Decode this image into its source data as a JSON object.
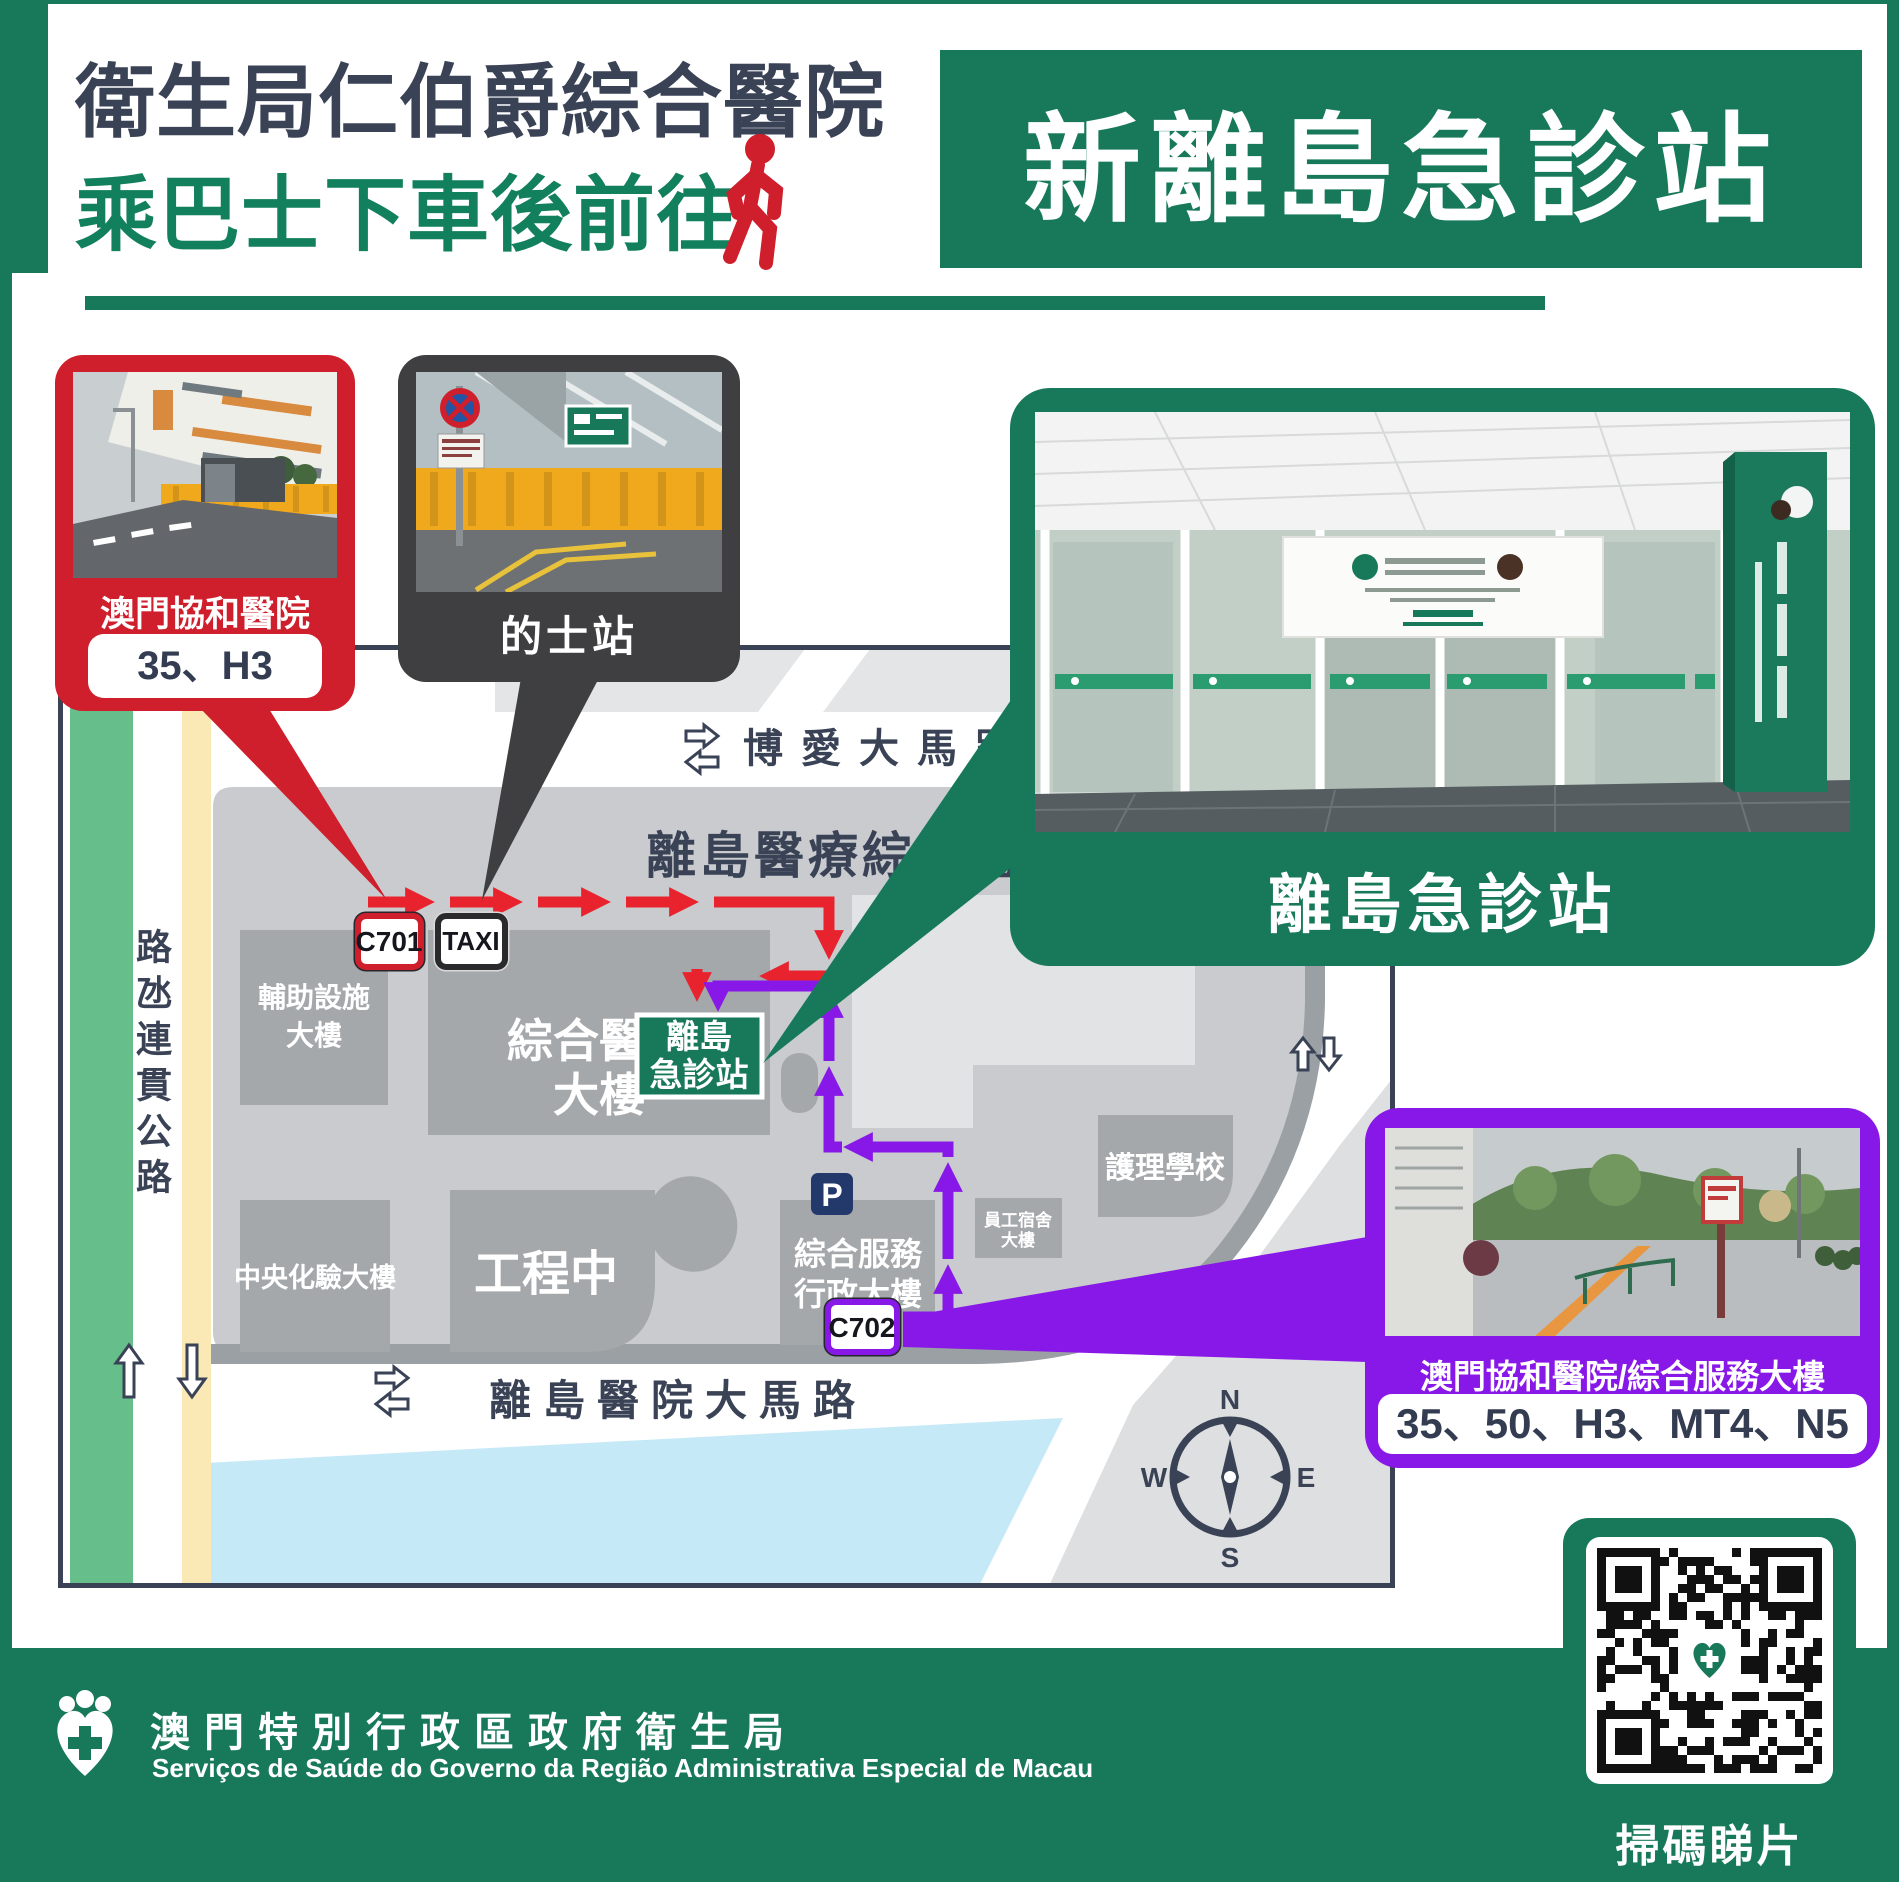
{
  "colors": {
    "brand_green": "#17795A",
    "navy": "#3A4256",
    "red": "#CF1F2C",
    "arrow_red": "#E8232E",
    "purple": "#8818E8",
    "dark_gray": "#3F3F41",
    "water_blue": "#C5E9F7"
  },
  "header": {
    "title_line1": "衛生局仁伯爵綜合醫院",
    "title_line2": "乘巴士下車後前往",
    "badge": "新離島急診站"
  },
  "callouts": {
    "red_bus_stop": {
      "label": "澳門協和醫院",
      "routes": "35、H3"
    },
    "taxi": {
      "label": "的士站"
    },
    "emergency": {
      "label": "離島急診站"
    },
    "purple_bus_stop": {
      "label": "澳門協和醫院/綜合服務大樓",
      "routes": "35、50、H3、MT4、N5"
    }
  },
  "map": {
    "complex_title": "離島醫療綜合體",
    "roads": {
      "north": "博愛大馬路",
      "south": "離島醫院大馬路",
      "west_vertical": "路氹連貫公路"
    },
    "stops": {
      "c701": "C701",
      "taxi": "TAXI",
      "c702": "C702"
    },
    "parking": "P",
    "emergency_station": {
      "line1": "離島",
      "line2": "急診站"
    },
    "buildings": [
      {
        "id": "auxiliary-facilities",
        "line1": "輔助設施",
        "line2": "大樓"
      },
      {
        "id": "general-hospital",
        "line1": "綜合醫院",
        "line2": "大樓"
      },
      {
        "id": "central-lab",
        "line1": "中央化驗大樓",
        "line2": ""
      },
      {
        "id": "under-construction",
        "line1": "工程中",
        "line2": ""
      },
      {
        "id": "admin-services",
        "line1": "綜合服務",
        "line2": "行政大樓"
      },
      {
        "id": "staff-dorm",
        "line1": "員工宿舍",
        "line2": "大樓"
      },
      {
        "id": "nursing-school",
        "line1": "護理學校",
        "line2": ""
      }
    ],
    "compass": {
      "n": "N",
      "s": "S",
      "e": "E",
      "w": "W"
    }
  },
  "qr": {
    "caption": "掃碼睇片"
  },
  "footer": {
    "org_zh": "澳門特別行政區政府衛生局",
    "org_pt": "Serviços de Saúde do Governo da Região Administrativa Especial de Macau"
  }
}
